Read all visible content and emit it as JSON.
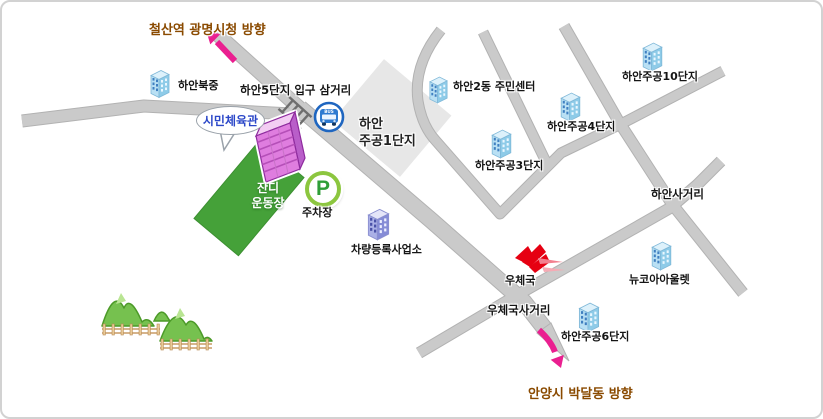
{
  "labels": {
    "direction_top": "철산역 광명시청 방향",
    "school": "하안북중",
    "entrance_intersection": "하안5단지 입구 삼거리",
    "gym_bubble": "시민체육관",
    "complex1_l1": "하안",
    "complex1_l2": "주공1단지",
    "grass_l1": "잔디",
    "grass_l2": "운동장",
    "parking_symbol": "P",
    "parking": "주차장",
    "bus_badge": "BUS",
    "vehicle_office": "차량등록사업소",
    "community_center": "하안2동 주민센터",
    "complex3": "하안주공3단지",
    "complex4": "하안주공4단지",
    "complex10": "하안주공10단지",
    "complex6": "하안주공6단지",
    "newcore_outlet": "뉴코아아울렛",
    "post_office": "우체국",
    "post_office_intersection": "우체국사거리",
    "haan_intersection": "하안사거리",
    "direction_bottom": "안양시 박달동 방향"
  },
  "icons": {
    "bus": "bus-front-in-blue-circle",
    "parking": "letter-P-green-ring",
    "post": "korea-post-red-swallow",
    "crosswalk": "ladder-crosswalk",
    "arrow_top": "pink-arrow-up-left",
    "arrow_bottom": "pink-arrow-down-right",
    "building_blue": "blue-apartment-3d",
    "building_purple": "purple-office-3d",
    "gym": "pink-gymnasium-3d",
    "trees": "green-hills-with-fences"
  },
  "colors": {
    "road": "#cacaca",
    "road_edge": "#b2b2b2",
    "block_gray": "#e7e7e7",
    "grass_green": "#45a139",
    "pink_accent": "#ea1f90",
    "direction_text": "#8a4a00",
    "bubble_text": "#2b47c8",
    "parking_ring": "#8cc63f",
    "parking_letter": "#2f9e38",
    "post_red": "#e60012",
    "bus_blue": "#1f66c0"
  }
}
